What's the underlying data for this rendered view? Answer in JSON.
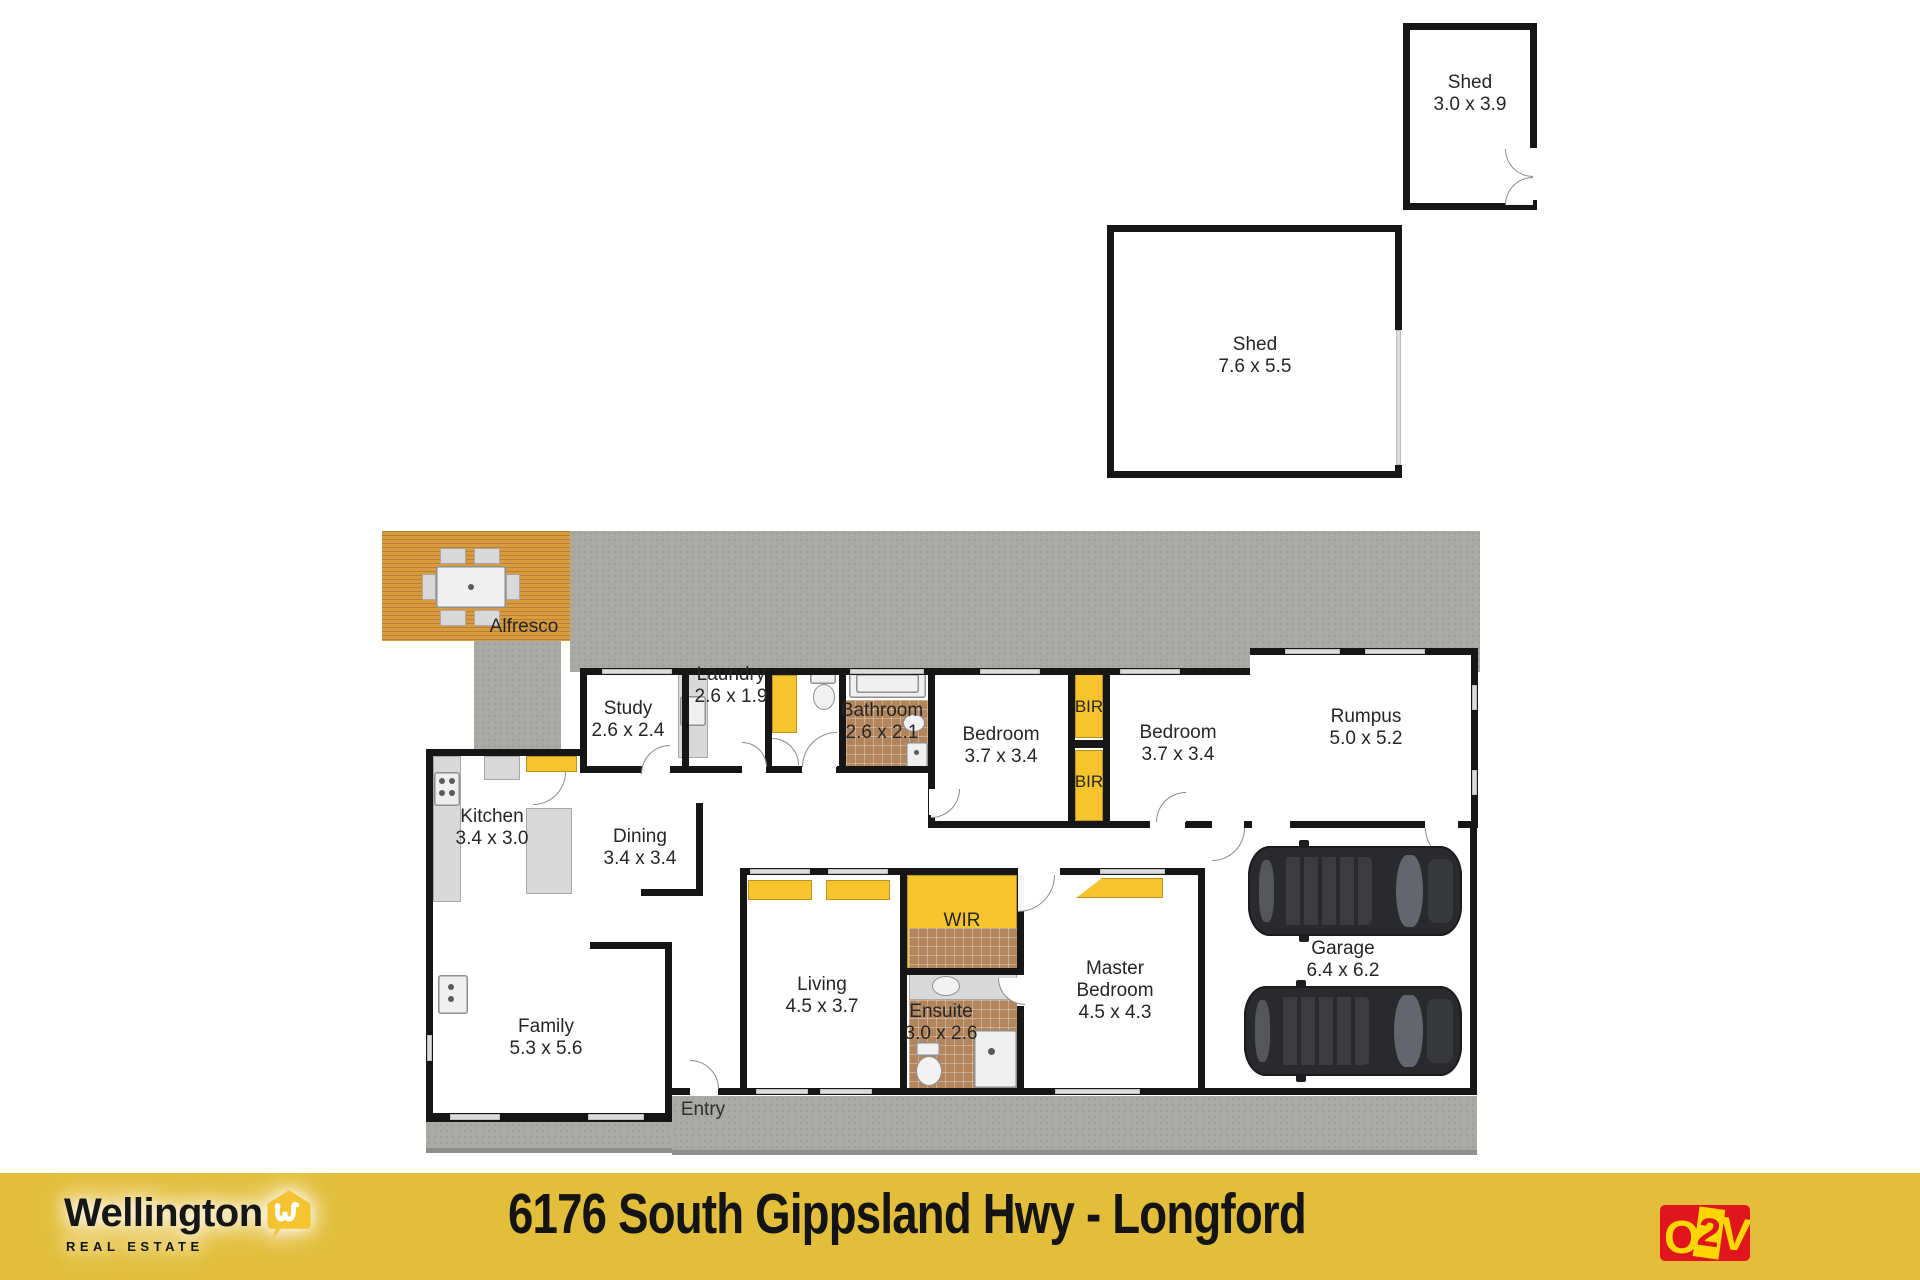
{
  "page": {
    "width": 1920,
    "height": 1280,
    "background": "#ffffff"
  },
  "colors": {
    "storage_yellow": "#f6c52e",
    "footer_yellow": "#e3be3a",
    "logo_red": "#e0151d",
    "concrete": "#a9a9a6",
    "deck_timber": "#d89b40",
    "tile_brown": "#b3855c",
    "wall_black": "#161616"
  },
  "labels": {
    "shed_small": {
      "line1": "Shed",
      "line2": "3.0 x 3.9"
    },
    "shed_large": {
      "line1": "Shed",
      "line2": "7.6 x 5.5"
    },
    "alfresco": {
      "line1": "Alfresco"
    },
    "study": {
      "line1": "Study",
      "line2": "2.6 x 2.4"
    },
    "laundry": {
      "line1": "Laundry",
      "line2": "2.6 x 1.9"
    },
    "bathroom": {
      "line1": "Bathroom",
      "line2": "2.6 x 2.1"
    },
    "bedroom1": {
      "line1": "Bedroom",
      "line2": "3.7 x 3.4"
    },
    "bir_upper": {
      "line1": "BIR"
    },
    "bir_lower": {
      "line1": "BIR"
    },
    "bedroom2": {
      "line1": "Bedroom",
      "line2": "3.7 x 3.4"
    },
    "rumpus": {
      "line1": "Rumpus",
      "line2": "5.0 x 5.2"
    },
    "kitchen": {
      "line1": "Kitchen",
      "line2": "3.4 x 3.0"
    },
    "dining": {
      "line1": "Dining",
      "line2": "3.4 x 3.4"
    },
    "family": {
      "line1": "Family",
      "line2": "5.3 x 5.6"
    },
    "wir": {
      "line1": "WIR"
    },
    "living": {
      "line1": "Living",
      "line2": "4.5 x 3.7"
    },
    "ensuite": {
      "line1": "Ensuite",
      "line2": "3.0 x 2.6"
    },
    "master_bedroom": {
      "line1": "Master",
      "line2": "Bedroom",
      "line3": "4.5 x 4.3"
    },
    "garage": {
      "line1": "Garage",
      "line2": "6.4 x 6.2"
    },
    "entry": {
      "line1": "Entry"
    }
  },
  "footer": {
    "address": "6176 South Gippsland Hwy - Longford",
    "agency_name": "Wellington",
    "agency_subtitle": "REAL ESTATE",
    "photographer_logo": {
      "o": "O",
      "two": "2",
      "v": "V"
    }
  }
}
